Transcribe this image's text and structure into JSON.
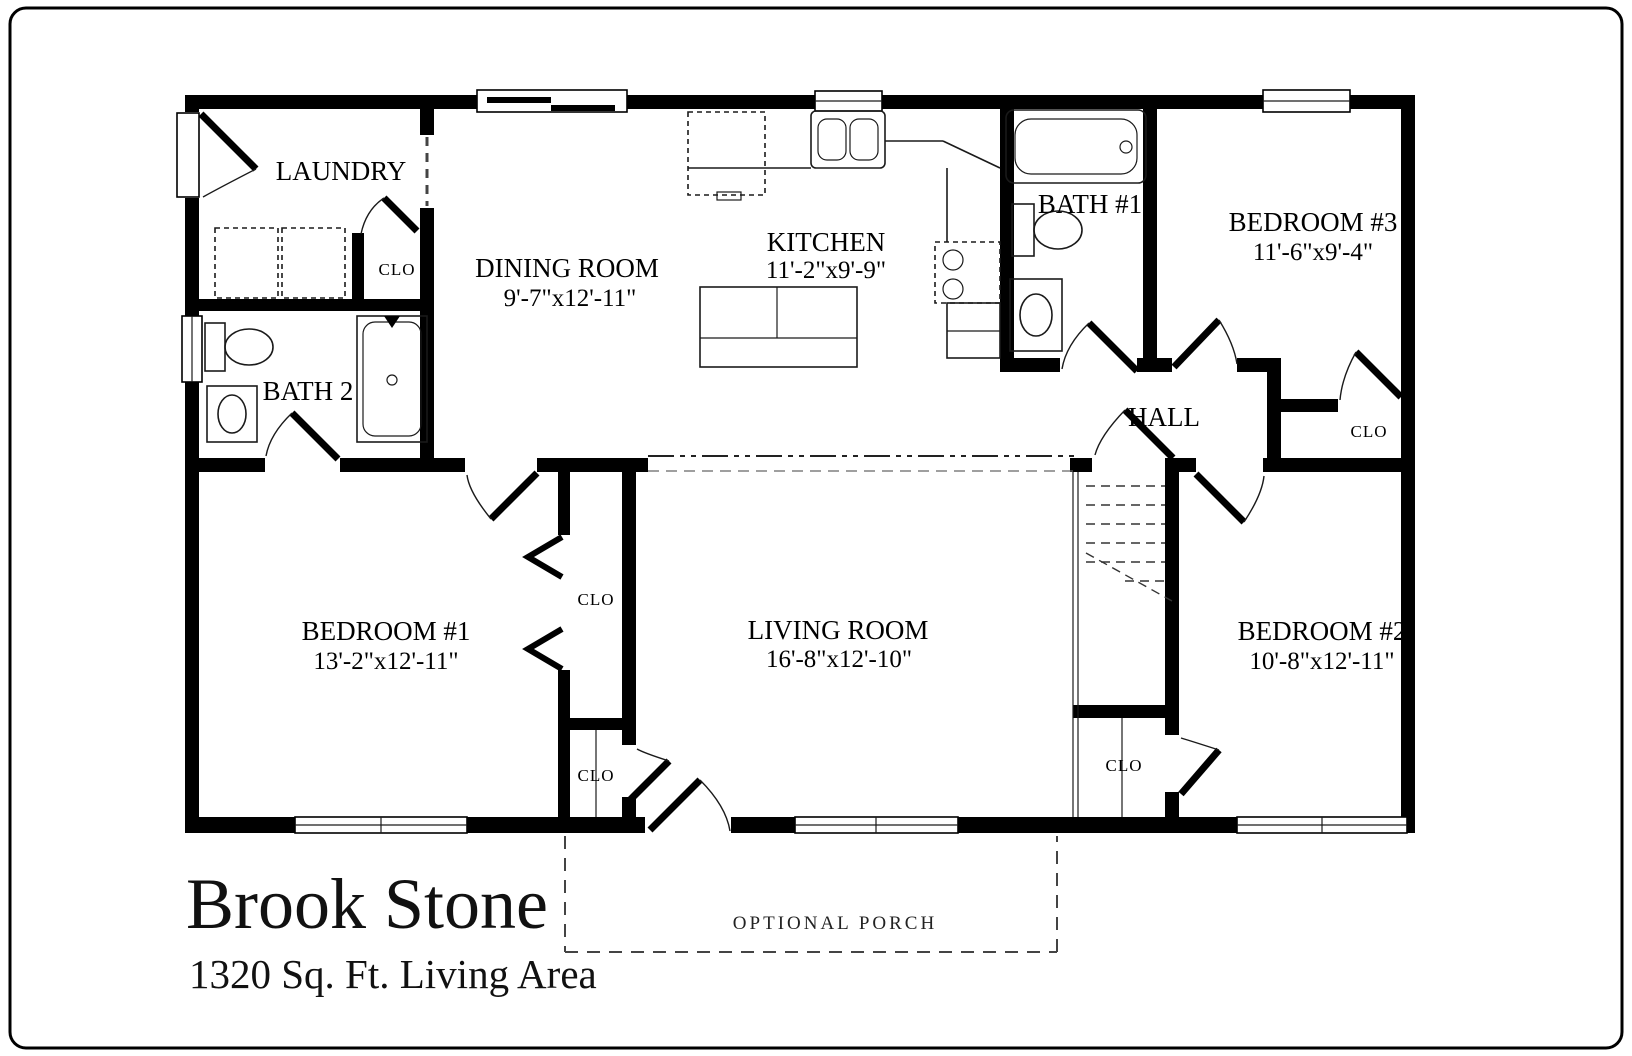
{
  "plan": {
    "title": "Brook Stone",
    "subtitle": "1320 Sq. Ft. Living Area",
    "rooms": {
      "laundry": {
        "name": "LAUNDRY"
      },
      "dining": {
        "name": "DINING ROOM",
        "dims": "9'-7\"x12'-11\""
      },
      "kitchen": {
        "name": "KITCHEN",
        "dims": "11'-2\"x9'-9\""
      },
      "bath1": {
        "name": "BATH #1"
      },
      "bedroom3": {
        "name": "BEDROOM #3",
        "dims": "11'-6\"x9'-4\""
      },
      "bath2": {
        "name": "BATH 2"
      },
      "hall": {
        "name": "HALL"
      },
      "bedroom1": {
        "name": "BEDROOM #1",
        "dims": "13'-2\"x12'-11\""
      },
      "living": {
        "name": "LIVING ROOM",
        "dims": "16'-8\"x12'-10\""
      },
      "bedroom2": {
        "name": "BEDROOM #2",
        "dims": "10'-8\"x12'-11\""
      },
      "porch": {
        "name": "OPTIONAL PORCH"
      }
    },
    "closet_label": "CLO",
    "colors": {
      "wall": "#000000",
      "background": "#ffffff"
    }
  }
}
